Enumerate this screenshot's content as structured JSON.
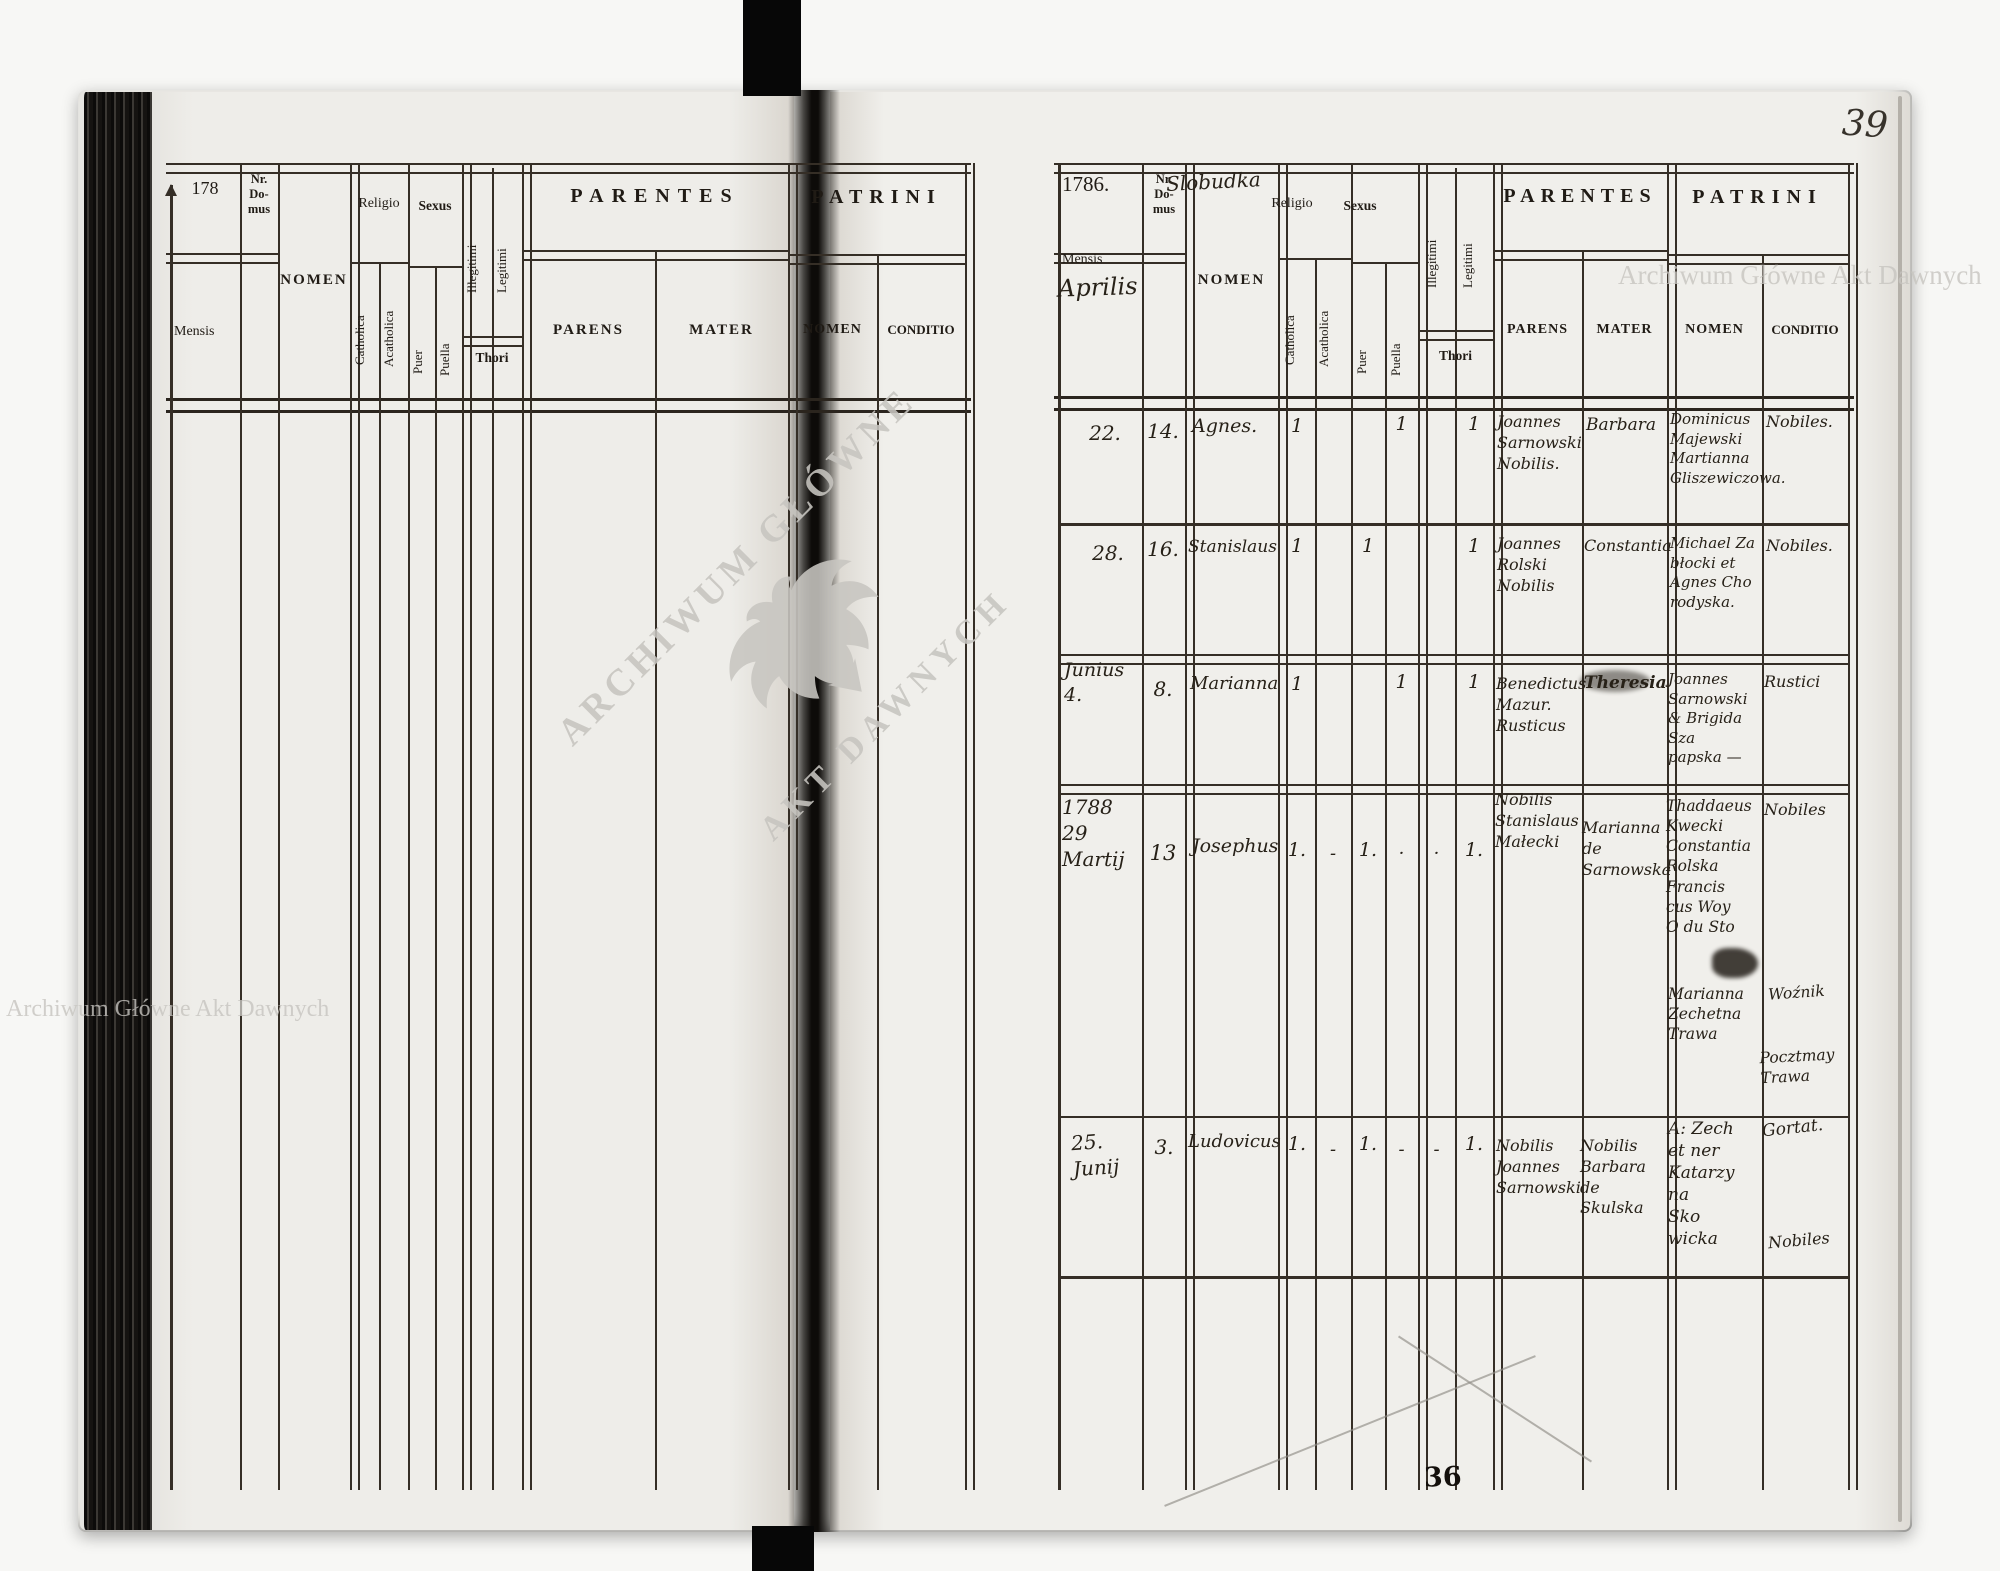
{
  "scan": {
    "right_folio": "39",
    "bottom_stamp": "36",
    "watermarks": {
      "horizontal_text": "Archiwum Główne Akt Dawnych",
      "stamp_line1": "ARCHIWUM GŁÓWNE",
      "stamp_line2": "AKT DAWNYCH",
      "color": "#c8c6c1"
    }
  },
  "headers": {
    "mensis": "Mensis",
    "nr_domus": "Nr.\nDo-\nmus",
    "nomen": "NOMEN",
    "religio": "Religio",
    "catholica": "Catholica",
    "acatholica": "Acatholica",
    "sexus": "Sexus",
    "puer": "Puer",
    "puella": "Puella",
    "illegitimi": "Illegitimi",
    "legitimi": "Legitimi",
    "thori": "Thori",
    "parentes": "PARENTES",
    "parens": "PARENS",
    "mater": "MATER",
    "patrini": "PATRINI",
    "patrini_nomen": "NOMEN",
    "conditio": "CONDITIO"
  },
  "left_page": {
    "folio": "178"
  },
  "right_page": {
    "year": "1786.",
    "village": "Slobudka",
    "month_annotation": "Aprilis",
    "rows": [
      {
        "mensis": "22.",
        "nr": "14.",
        "nomen": "Agnes.",
        "catholica": "1",
        "acatholica": "",
        "puer": "",
        "puella": "1",
        "illegitimi": "",
        "legitimi": "1",
        "parens": "Joannes\nSarnowski\nNobilis.",
        "mater": "Barbara",
        "patrini_nomen": "Dominicus\nMajewski\nMartianna\nGliszewiczowa.",
        "conditio": "Nobiles."
      },
      {
        "mensis": "28.",
        "nr": "16.",
        "nomen": "Stanislaus",
        "catholica": "1",
        "acatholica": "",
        "puer": "1",
        "puella": "",
        "illegitimi": "",
        "legitimi": "1",
        "parens": "Joannes\nRolski\nNobilis",
        "mater": "Constantia",
        "patrini_nomen": "Michael Za\nbłocki et\nAgnes Cho\nrodyska.",
        "conditio": "Nobiles."
      },
      {
        "mensis": "Junius\n4.",
        "nr": "8.",
        "nomen": "Marianna",
        "catholica": "1",
        "acatholica": "",
        "puer": "",
        "puella": "1",
        "illegitimi": "",
        "legitimi": "1",
        "parens": "Benedictus\nMazur.\nRusticus",
        "mater": "Theresia",
        "patrini_nomen": "Joannes\nSarnowski\n& Brigida Sza\npapska —",
        "conditio": "Rustici"
      },
      {
        "mensis": "1788\n29\nMartij",
        "nr": "13",
        "nomen": "Josephus",
        "catholica": "1.",
        "acatholica": "-",
        "puer": "1.",
        "puella": "·",
        "illegitimi": "·",
        "legitimi": "1.",
        "parens": "Nobilis\nStanislaus\nMałecki",
        "mater": "Marianna\nde\nSarnowska",
        "patrini_nomen": "Thaddaeus\nKwecki\nConstantia\nRolska\nFrancis\ncus Woy\nO du Sto",
        "patrini_nomen2": "Marianna\nZechetna\nTrawa",
        "conditio": "Nobiles",
        "conditio2": "Woźnik",
        "conditio3": "Pocztmay\nTrawa"
      },
      {
        "mensis": "25.\nJunij",
        "nr": "3.",
        "nomen": "Ludovicus",
        "catholica": "1.",
        "acatholica": "-",
        "puer": "1.",
        "puella": "-",
        "illegitimi": "-",
        "legitimi": "1.",
        "parens": "Nobilis\nJoannes\nSarnowski",
        "mater": "Nobilis\nBarbara\nde Skulska",
        "patrini_nomen": "A: Zech\net ner\nKatarzy\nna\nSko\nwicka",
        "conditio": "Gortat.",
        "conditio2": "Nobiles"
      }
    ]
  }
}
